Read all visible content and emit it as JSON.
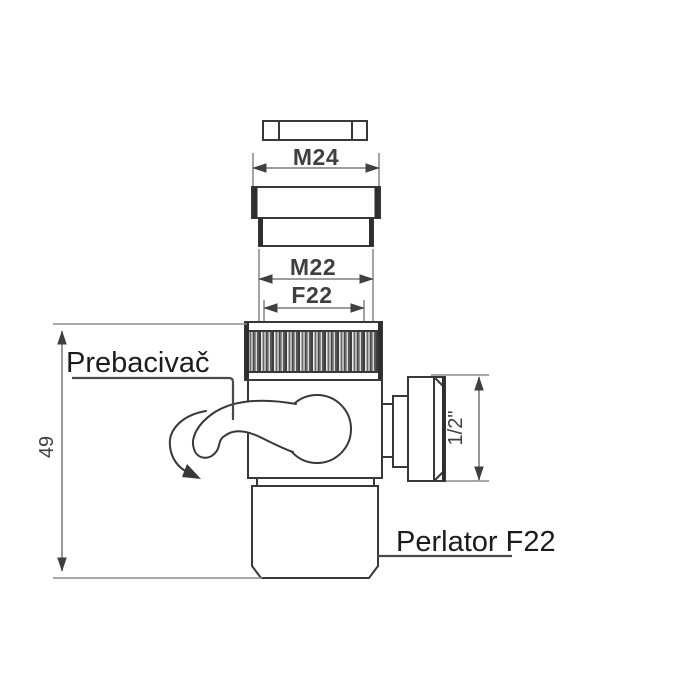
{
  "labels": {
    "dim_top_thread": "M24",
    "dim_male_thread": "M22",
    "dim_female_thread": "F22",
    "dim_side_thread": "1/2\"",
    "dim_height": "49",
    "callout_diverter": "Prebacivač",
    "callout_aerator": "Perlator F22"
  },
  "colors": {
    "background": "#ffffff",
    "outline": "#383838",
    "dimension_line": "#7d7d7d",
    "dimension_text": "#3f3f3f",
    "callout_text": "#1c1c1c",
    "knurl_dark": "#3e3e3e",
    "knurl_light": "#d9d9d9"
  }
}
